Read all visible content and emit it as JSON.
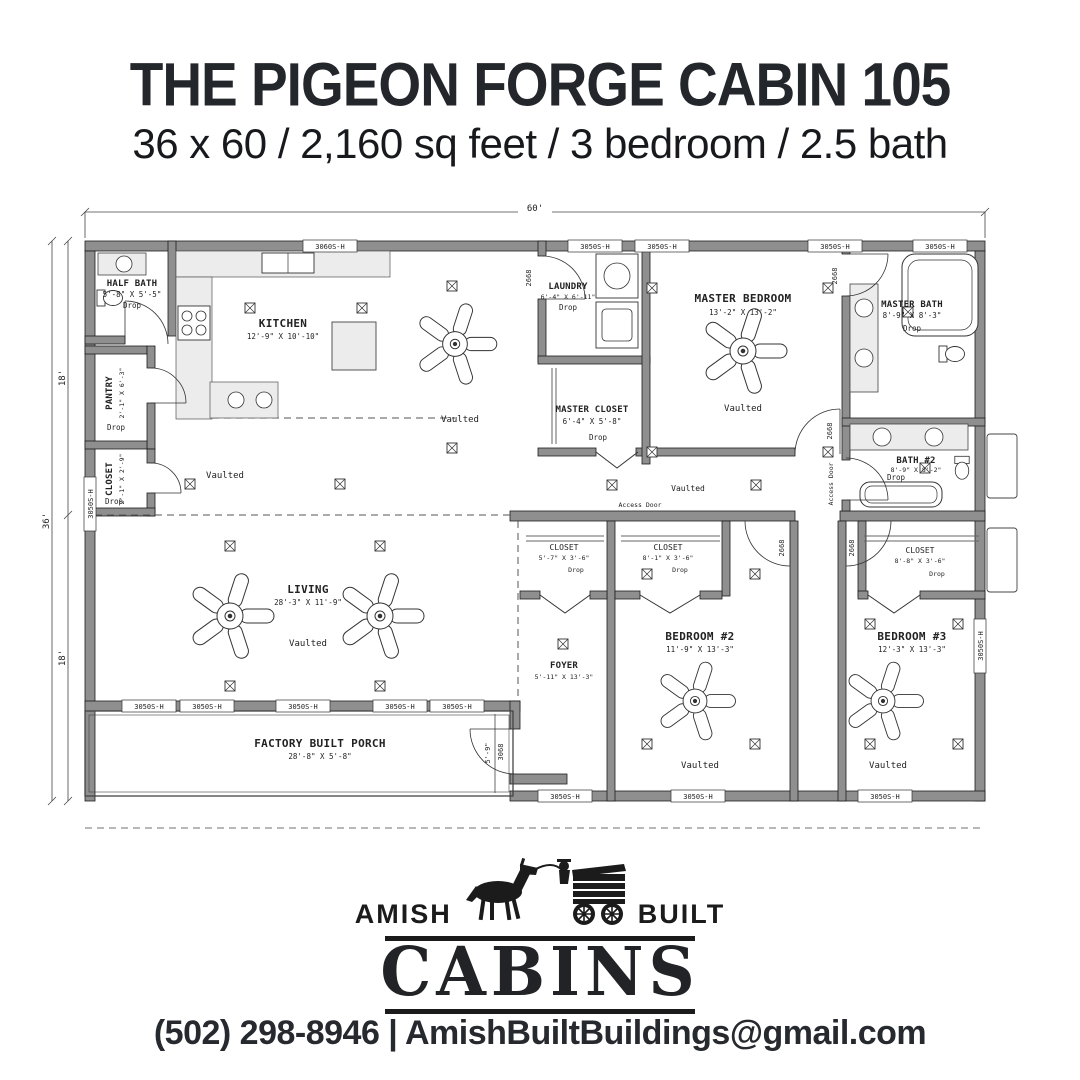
{
  "header": {
    "title": "THE PIGEON FORGE CABIN 105",
    "subtitle": "36 x 60 / 2,160 sq feet / 3 bedroom / 2.5 bath"
  },
  "plan": {
    "dimensions": {
      "width": "60'",
      "height": "36'",
      "upper": "18'",
      "lower": "18'",
      "porch_depth": "5'-9\""
    },
    "labels": {
      "vaulted": "Vaulted",
      "access_door": "Access Door",
      "window": "3050S-H",
      "window_kitchen": "3060S-H",
      "door_front": "3068",
      "door_interior": "2668"
    },
    "rooms": [
      {
        "name": "HALF BATH",
        "dims": "5'-8\" X 5'-5\"",
        "note": "Drop"
      },
      {
        "name": "PANTRY",
        "dims": "2'-1\" X 6'-3\"",
        "note": "Drop"
      },
      {
        "name": "CLOSET",
        "dims": "2'-1\" X 2'-9\"",
        "note": "Drop"
      },
      {
        "name": "KITCHEN",
        "dims": "12'-9\" X 10'-10\"",
        "note": ""
      },
      {
        "name": "LAUNDRY",
        "dims": "6'-4\" X 6'-11\"",
        "note": "Drop"
      },
      {
        "name": "MASTER CLOSET",
        "dims": "6'-4\" X 5'-8\"",
        "note": "Drop"
      },
      {
        "name": "MASTER BEDROOM",
        "dims": "13'-2\" X 13'-2\"",
        "note": "Vaulted"
      },
      {
        "name": "MASTER BATH",
        "dims": "8'-9\" X 8'-3\"",
        "note": "Drop"
      },
      {
        "name": "BATH #2",
        "dims": "8'-9\" X 8'-2\"",
        "note": "Drop"
      },
      {
        "name": "LIVING",
        "dims": "28'-3\" X 11'-9\"",
        "note": "Vaulted"
      },
      {
        "name": "FOYER",
        "dims": "5'-11\" X 13'-3\"",
        "note": ""
      },
      {
        "name": "CLOSET",
        "dims": "5'-7\" X 3'-6\"",
        "note": "Drop"
      },
      {
        "name": "CLOSET",
        "dims": "8'-1\" X 3'-6\"",
        "note": "Drop"
      },
      {
        "name": "BEDROOM #2",
        "dims": "11'-9\" X 13'-3\"",
        "note": "Vaulted"
      },
      {
        "name": "CLOSET",
        "dims": "8'-8\" X 3'-6\"",
        "note": "Drop"
      },
      {
        "name": "BEDROOM #3",
        "dims": "12'-3\" X 13'-3\"",
        "note": "Vaulted"
      },
      {
        "name": "FACTORY BUILT PORCH",
        "dims": "28'-8\" X 5'-8\"",
        "note": ""
      }
    ]
  },
  "logo": {
    "word_left": "AMISH",
    "word_right": "BUILT",
    "word_main": "CABINS"
  },
  "footer": {
    "contact": "(502) 298-8946 | AmishBuiltBuildings@gmail.com"
  }
}
